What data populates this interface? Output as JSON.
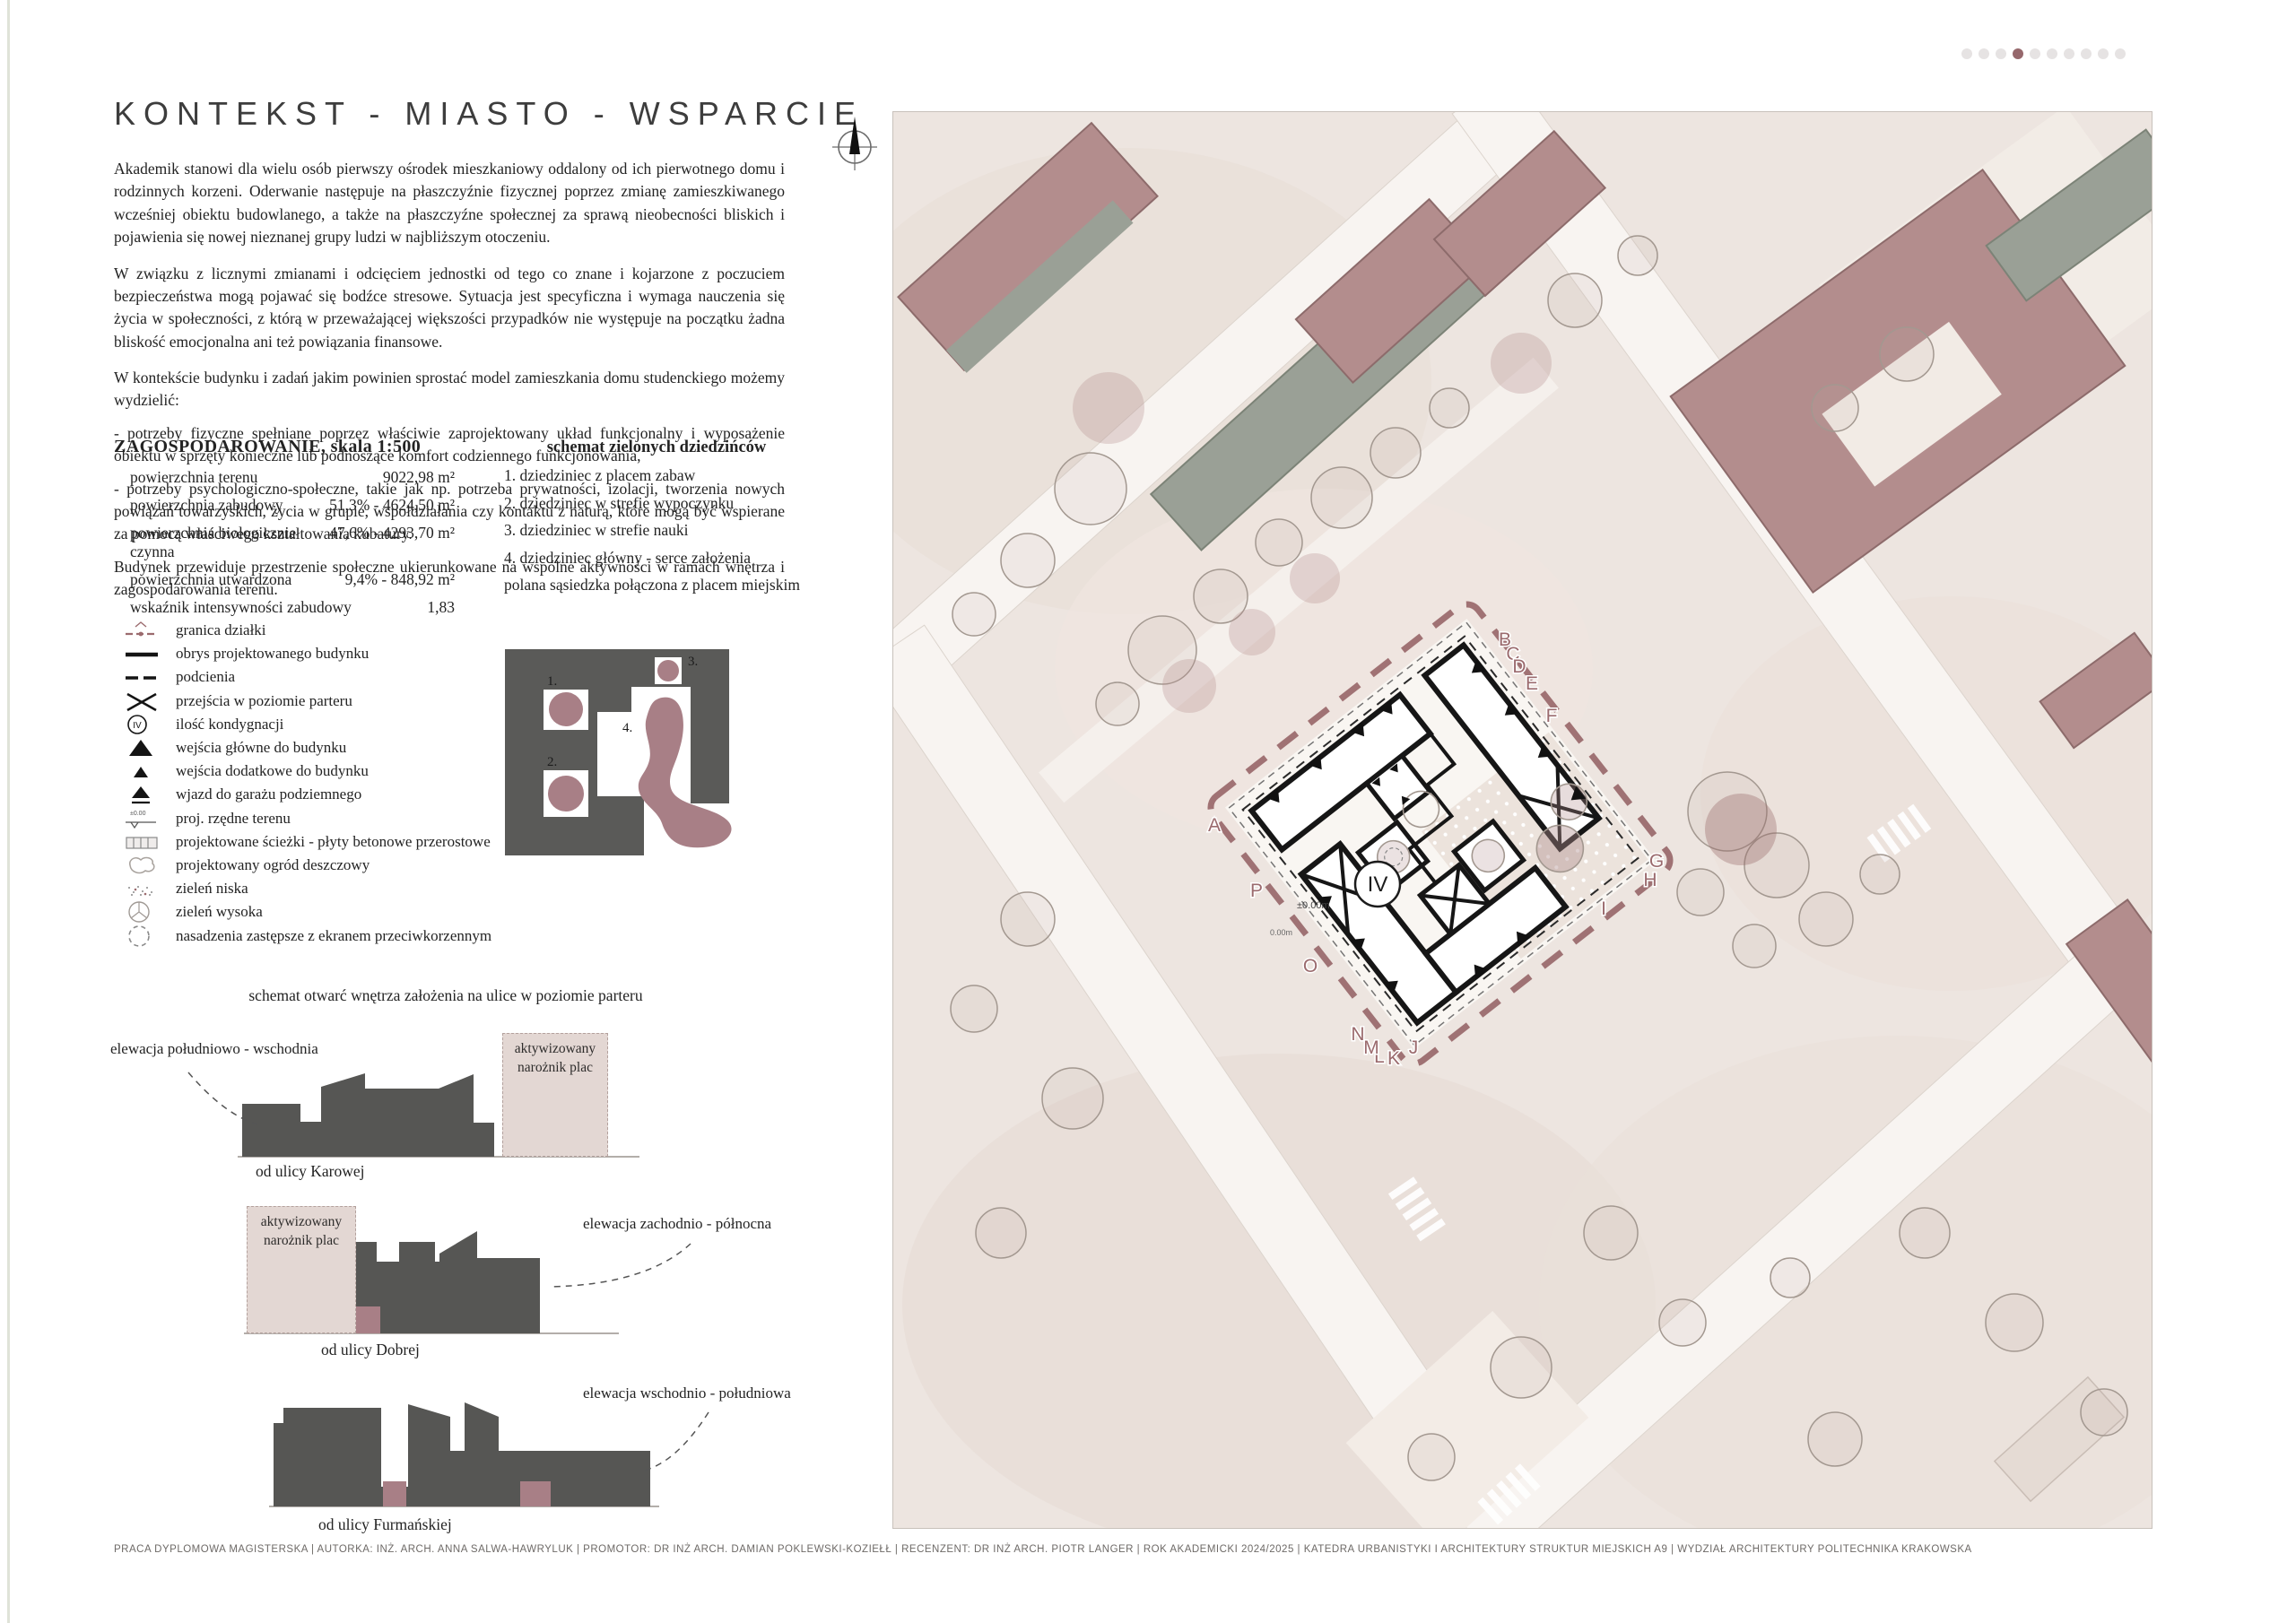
{
  "page": {
    "title": "KONTEKST - MIASTO - WSPARCIE",
    "accent_color": "#9b6b6e",
    "footer": "PRACA DYPLOMOWA MAGISTERSKA   |   AUTORKA: INŻ. ARCH. ANNA SALWA-HAWRYLUK   |   PROMOTOR: DR INŻ ARCH. DAMIAN POKLEWSKI-KOZIEŁŁ   |   RECENZENT: DR INŻ ARCH. PIOTR LANGER   |   ROK AKADEMICKI 2024/2025   |   KATEDRA URBANISTYKI I ARCHITEKTURY STRUKTUR MIEJSKICH A9   |   WYDZIAŁ ARCHITEKTURY POLITECHNIKA KRAKOWSKA"
  },
  "pagination": {
    "dot_count": 10,
    "active_index": 4,
    "active_color": "#96686c",
    "inactive_color": "#e6e3e3"
  },
  "intro": {
    "paragraphs": [
      "Akademik stanowi dla wielu osób pierwszy ośrodek mieszkaniowy oddalony od ich pierwotnego domu i rodzinnych korzeni. Oderwanie następuje na płaszczyźnie fizycznej poprzez zmianę zamieszkiwanego wcześniej obiektu budowlanego, a także na płaszczyźne społecznej za sprawą nieobecności bliskich i pojawienia się nowej nieznanej grupy ludzi w najbliższym otoczeniu.",
      "W związku z licznymi zmianami i odcięciem jednostki od tego co znane i kojarzone z poczuciem bezpieczeństwa mogą pojawać się bodźce stresowe. Sytuacja jest specyficzna i wymaga nauczenia się życia w społeczności, z którą w przeważającej większości przypadków nie występuje na początku żadna bliskość emocjonalna ani też powiązania finansowe.",
      "W kontekście budynku i zadań jakim powinien sprostać model zamieszkania domu studenckiego możemy wydzielić:"
    ],
    "bullets": [
      "- potrzeby fizyczne spełniane poprzez właściwie zaprojektowany układ funkcjonalny i wyposażenie obiektu w sprzęty konieczne lub podnoszące komfort codziennego funkcjonowania,",
      "- potrzeby psychologiczno-społeczne, takie jak np. potrzeba prywatności, izolacji, tworzenia nowych powiązań towarzyskich, życia w grupie, współdziałania czy kontaktu z naturą, które mogą być wspierane za pomocą właściwego kształtowania kubatury."
    ],
    "closing": "Budynek przewiduje przestrzenie społeczne ukierunkowane na wspólne aktywności w ramach wnętrza i zagospodarowania terenu."
  },
  "land_use": {
    "title": "ZAGOSPODAROWANIE, skala 1:500",
    "rows": [
      {
        "label": "powierzchnia terenu",
        "value": "9022,98 m²"
      },
      {
        "label": "powierzchnia zabudowy",
        "value": "51,3% - 4624,50 m²"
      },
      {
        "label": "powierzchnia biologicznie czynna",
        "value": "47,6% - 4293,70 m²"
      },
      {
        "label": "powierzchnia utwardzona",
        "value": "9,4% - 848,92 m²"
      },
      {
        "label": "wskaźnik intensywności zabudowy",
        "value": "1,83"
      }
    ]
  },
  "green_courtyards": {
    "title": "schemat zielonych dziedzińców",
    "items": [
      "1. dziedziniec z placem zabaw",
      "2. dziedziniec w strefie wypoczynku",
      "3. dziedziniec w strefie nauki",
      "4. dziedziniec główny - serce założenia",
      "polana sąsiedzka połączona z placem miejskim"
    ]
  },
  "legend": {
    "items": [
      {
        "icon": "plot-boundary-icon",
        "label": "granica działki"
      },
      {
        "icon": "building-outline-icon",
        "label": "obrys projektowanego budynku"
      },
      {
        "icon": "arcade-icon",
        "label": "podcienia"
      },
      {
        "icon": "ground-passage-icon",
        "label": "przejścia w poziomie parteru"
      },
      {
        "icon": "storeys-icon",
        "label": "ilość kondygnacji"
      },
      {
        "icon": "main-entrance-icon",
        "label": "wejścia główne do budynku"
      },
      {
        "icon": "side-entrance-icon",
        "label": "wejścia dodatkowe do budynku"
      },
      {
        "icon": "garage-entry-icon",
        "label": "wjazd do garażu podziemnego"
      },
      {
        "icon": "spot-level-icon",
        "label": "proj. rzędne terenu"
      },
      {
        "icon": "paths-icon",
        "label": "projektowane ścieżki - płyty betonowe przerostowe"
      },
      {
        "icon": "rain-garden-icon",
        "label": "projektowany ogród deszczowy"
      },
      {
        "icon": "low-greenery-icon",
        "label": "zieleń niska"
      },
      {
        "icon": "high-greenery-icon",
        "label": "zieleń wysoka"
      },
      {
        "icon": "replacement-planting-icon",
        "label": "nasadzenia zastępsze z ekranem przeciwkorzennym"
      }
    ],
    "storeys_badge": "IV"
  },
  "courtyard_diagram": {
    "labels": [
      "1.",
      "2.",
      "3.",
      "4."
    ]
  },
  "elevations_section": {
    "heading": "schemat otwarć wnętrza założenia na ulice w poziomie parteru",
    "items": [
      {
        "label": "elewacja południowo - wschodnia",
        "street": "od ulicy Karowej",
        "corner": "aktywizowany narożnik plac"
      },
      {
        "label": "elewacja zachodnio - północna",
        "street": "od ulicy Dobrej",
        "corner": "aktywizowany narożnik plac"
      },
      {
        "label": "elewacja wschodnio - południowa",
        "street": "od ulicy Furmańskiej"
      }
    ]
  },
  "site_plan": {
    "floors_badge": "IV",
    "spot_level_main": "±0.00m",
    "spot_level_secondary": "0.00m",
    "boundary_letters": [
      "A",
      "B",
      "C",
      "D",
      "E",
      "F",
      "G",
      "H",
      "I",
      "J",
      "K",
      "L",
      "M",
      "N",
      "O",
      "P"
    ]
  }
}
